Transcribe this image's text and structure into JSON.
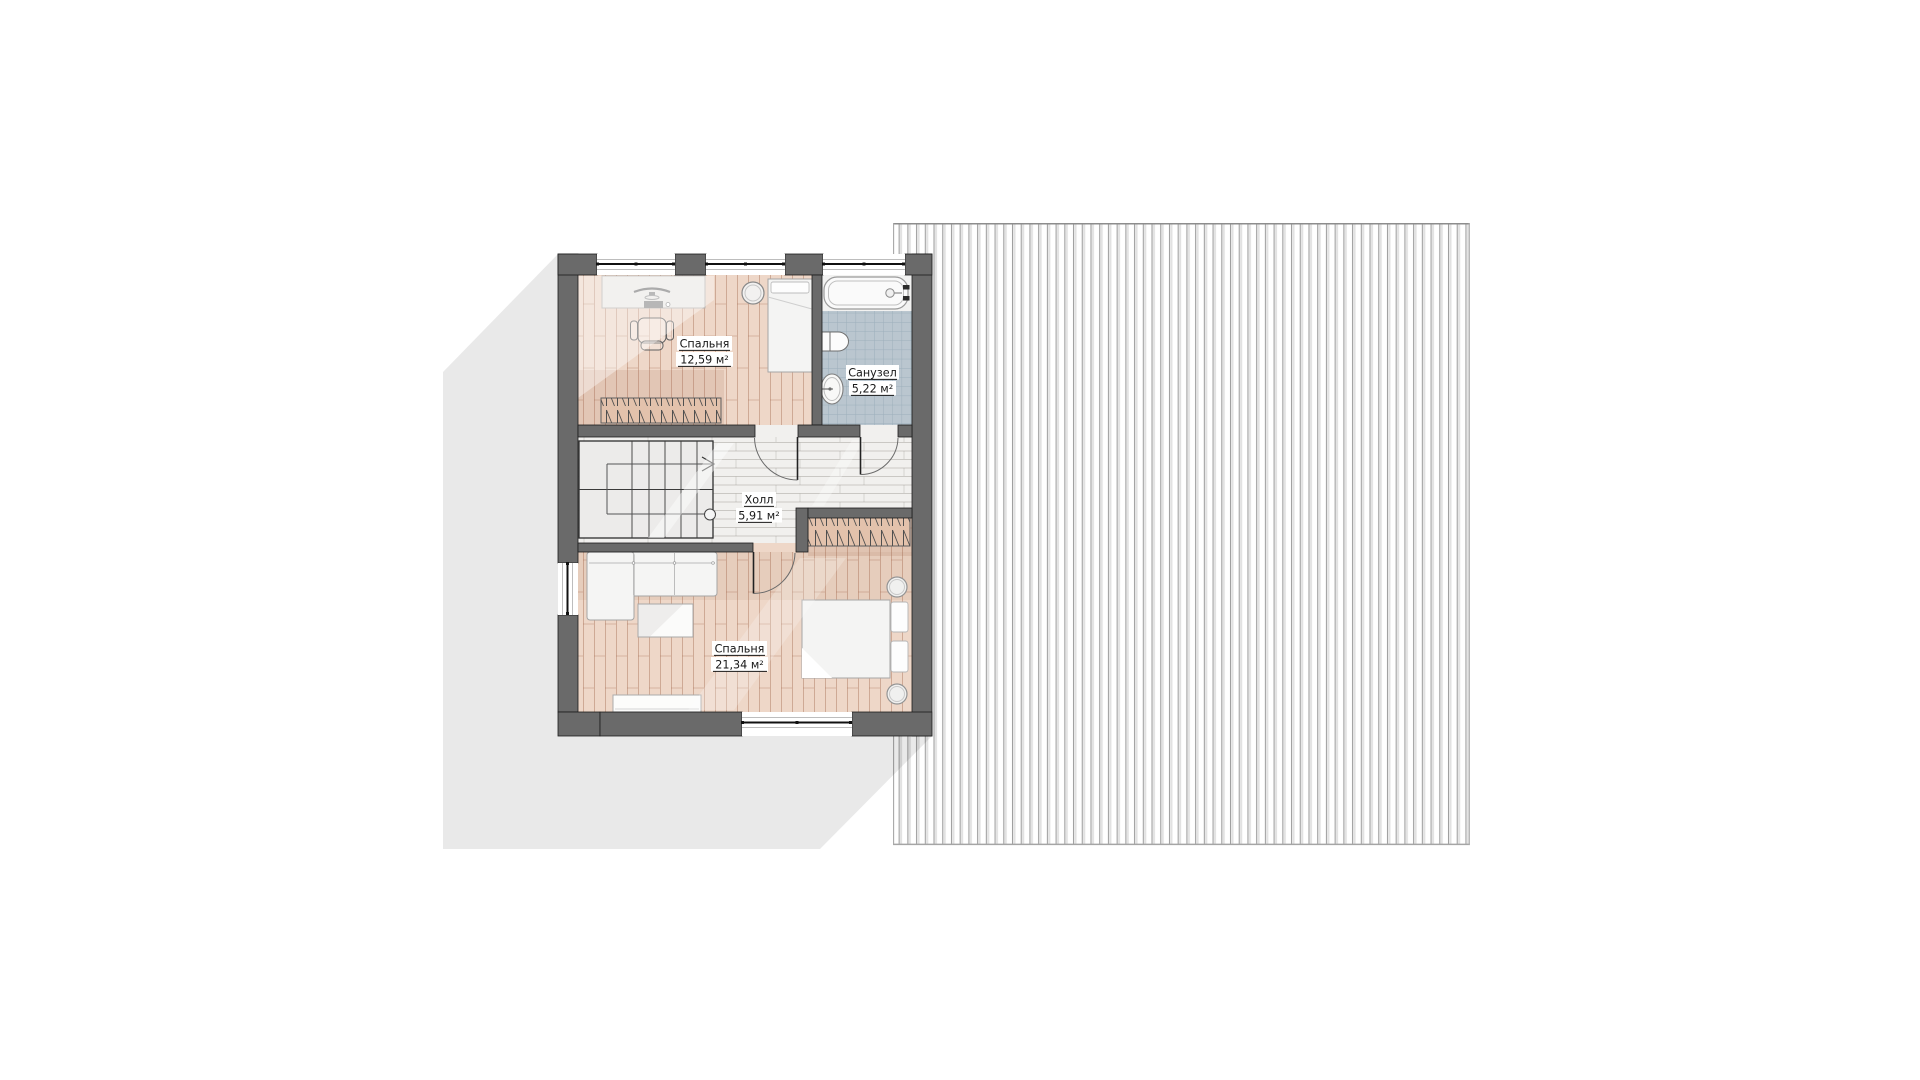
{
  "plan": {
    "type": "second-floor-plan",
    "rooms": [
      {
        "key": "bedroom-1",
        "name": "Спальня",
        "area": "12,59 м²"
      },
      {
        "key": "bathroom",
        "name": "Санузел",
        "area": "5,22 м²"
      },
      {
        "key": "hall",
        "name": "Холл",
        "area": "5,91 м²"
      },
      {
        "key": "bedroom-2",
        "name": "Спальня",
        "area": "21,34 м²"
      }
    ],
    "colors": {
      "wall_fill": "#6a6a6a",
      "wall_outline": "#1c1c1c",
      "wood_floor": "#eed7c8",
      "wood_plank_line": "#c49a82",
      "tile_floor": "#bac6cf",
      "tile_grid_line": "#9cafbb",
      "hall_floor": "#f1f0ee",
      "stair_floor": "#ecebea",
      "roof_stripe": "#9e9e9e",
      "house_shadow": "rgba(0,0,0,0.085)",
      "label_text": "#181818"
    }
  }
}
